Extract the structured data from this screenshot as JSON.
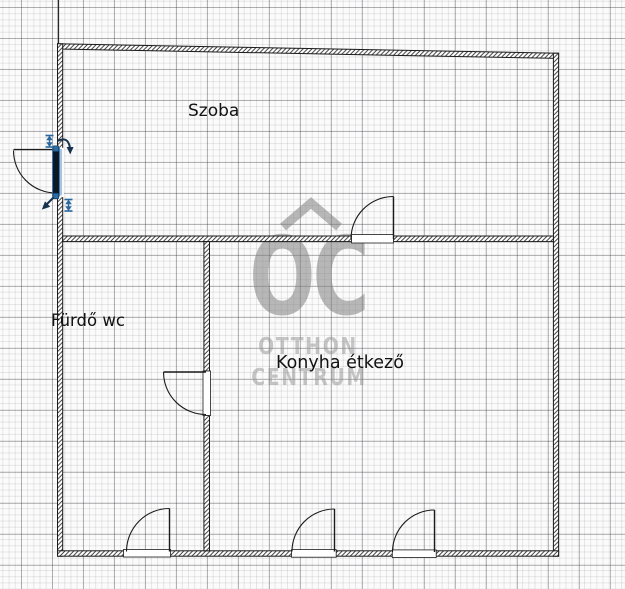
{
  "canvas": {
    "background_color": "#fbfbfb",
    "grid": {
      "minor_spacing_px": 6.2,
      "major_spacing_px": 31,
      "minor_color": "#e8e8ea",
      "major_color": "#bcbcbf"
    }
  },
  "rooms": [
    {
      "id": "szoba",
      "label": "Szoba"
    },
    {
      "id": "furdo-wc",
      "label": "Fürdő wc"
    },
    {
      "id": "konyha-etkezo",
      "label": "Konyha étkező"
    }
  ],
  "walls": {
    "color": "#1b1b1b",
    "fill": "diagonal-hatch"
  },
  "doors": [
    {
      "id": "entry-door-left",
      "wall": "left-exterior",
      "selected": true
    },
    {
      "id": "szoba-door",
      "wall": "szoba-divider",
      "selected": false
    },
    {
      "id": "furdo-door",
      "wall": "furdo-konyha-divider",
      "selected": false
    },
    {
      "id": "furdo-bottom-door",
      "wall": "bottom-exterior",
      "selected": false
    },
    {
      "id": "konyha-bottom-door-1",
      "wall": "bottom-exterior",
      "selected": false
    },
    {
      "id": "konyha-bottom-door-2",
      "wall": "bottom-exterior",
      "selected": false
    }
  ],
  "selection": {
    "target": "entry-door-left",
    "accent_color": "#2e6da4",
    "leaf_fill_color": "#0d1625",
    "handles": [
      {
        "icon": "resize-length-icon",
        "position": "top-left"
      },
      {
        "icon": "rotate-arrow-icon",
        "position": "top-right"
      },
      {
        "icon": "resize-length-icon",
        "position": "bottom-right"
      },
      {
        "icon": "move-arrow-icon",
        "position": "bottom-left"
      }
    ]
  },
  "watermark": {
    "roof_icon": "roof-chevron-icon",
    "monogram": "OC",
    "line1": "OTTHON",
    "line2": "CENTRUM"
  }
}
